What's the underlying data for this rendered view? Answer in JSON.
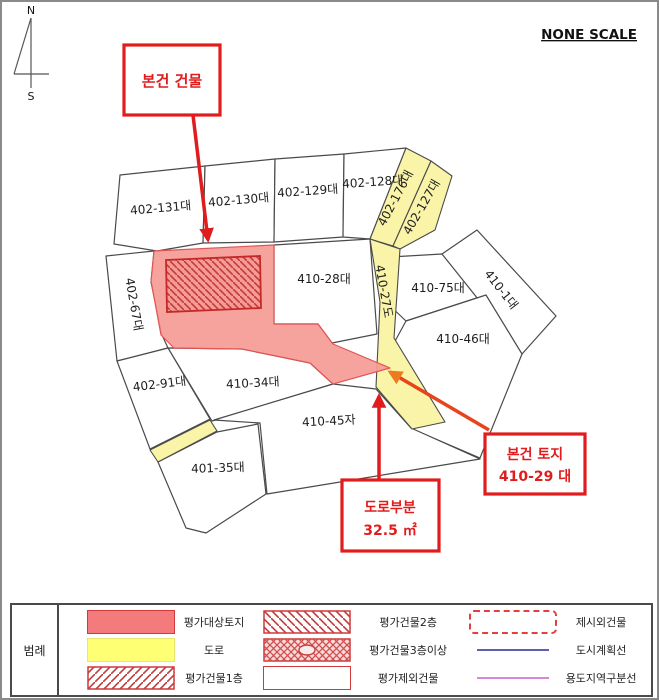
{
  "compass": {
    "north": "N",
    "south": "S"
  },
  "scale_note": "NONE SCALE",
  "map": {
    "parcels": [
      {
        "label": "402-131대"
      },
      {
        "label": "402-130대"
      },
      {
        "label": "402-129대"
      },
      {
        "label": "402-128대"
      },
      {
        "label": "402-176대"
      },
      {
        "label": "402-127대"
      },
      {
        "label": "402-67대"
      },
      {
        "label": "410-28대"
      },
      {
        "label": "410-27도"
      },
      {
        "label": "410-75대"
      },
      {
        "label": "410-1대"
      },
      {
        "label": "410-46대"
      },
      {
        "label": "402-91대"
      },
      {
        "label": "410-34대"
      },
      {
        "label": "410-45자"
      },
      {
        "label": "401-35대"
      }
    ]
  },
  "callouts": {
    "building": {
      "text": "본건 건물"
    },
    "land": {
      "line1": "본건 토지",
      "line2": "410-29 대"
    },
    "road_portion": {
      "line1": "도로부분",
      "line2": "32.5 ㎡"
    }
  },
  "legend": {
    "title": "범례",
    "items": [
      {
        "label": "평가대상토지",
        "swatch": "pink-fill"
      },
      {
        "label": "도로",
        "swatch": "yellow-fill"
      },
      {
        "label": "평가건물1층",
        "swatch": "hatch-forward"
      },
      {
        "label": "평가건물2층",
        "swatch": "hatch-back"
      },
      {
        "label": "평가건물3층이상",
        "swatch": "crosshatch-ellipse"
      },
      {
        "label": "평가제외건물",
        "swatch": "white-box"
      },
      {
        "label": "제시외건물",
        "swatch": "dashed-box"
      },
      {
        "label": "도시계획선",
        "swatch": "blue-line"
      },
      {
        "label": "용도지역구분선",
        "swatch": "purple-line"
      }
    ]
  },
  "colors": {
    "subject_land": "#F59B96",
    "road": "#FAF4A8",
    "accent_red": "#E11C1C",
    "hatch_red": "#C23B3B",
    "city_plan_line": "#6060B0",
    "zoning_line": "#D887D8"
  }
}
